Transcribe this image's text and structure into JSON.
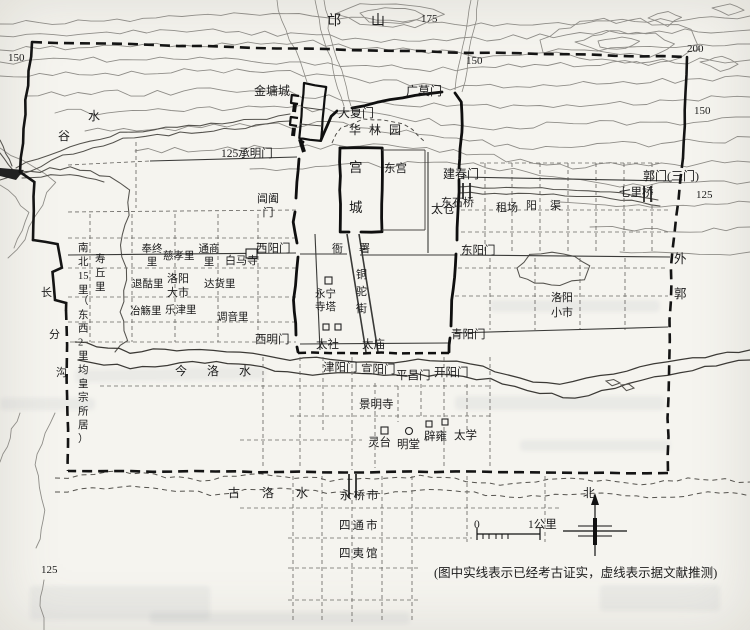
{
  "map": {
    "legend_note": "(图中实线表示已经考古证实，虚线表示据文献推测)",
    "scale": {
      "start": "0",
      "end": "1公里"
    },
    "compass": {
      "north": "北"
    },
    "contour_values": [
      "125",
      "150",
      "175",
      "200"
    ],
    "labels": [
      {
        "n": "contour-label-175",
        "t": "175",
        "x": 421,
        "y": 22,
        "s": 11
      },
      {
        "n": "contour-label-150-nw",
        "t": "150",
        "x": 8,
        "y": 61,
        "s": 11
      },
      {
        "n": "contour-label-150-n",
        "t": "150",
        "x": 466,
        "y": 64,
        "s": 11
      },
      {
        "n": "contour-label-200-ne",
        "t": "200",
        "x": 687,
        "y": 52,
        "s": 11
      },
      {
        "n": "contour-label-150-ne",
        "t": "150",
        "x": 694,
        "y": 114,
        "s": 11
      },
      {
        "n": "contour-label-125-e",
        "t": "125",
        "x": 696,
        "y": 198,
        "s": 11
      },
      {
        "n": "contour-label-125-sw",
        "t": "125",
        "x": 41,
        "y": 573,
        "s": 11
      },
      {
        "n": "mang-shan-label",
        "t": "邙山",
        "x": 327,
        "y": 25,
        "s": 14,
        "ls": 30
      },
      {
        "n": "gu-shui-label-1",
        "t": "谷",
        "x": 58,
        "y": 140,
        "s": 12
      },
      {
        "n": "gu-shui-label-2",
        "t": "水",
        "x": 88,
        "y": 120,
        "s": 12
      },
      {
        "n": "changfengou-label-1",
        "t": "长",
        "x": 41,
        "y": 296,
        "s": 11
      },
      {
        "n": "changfengou-label-2",
        "t": "分",
        "x": 49,
        "y": 338,
        "s": 11
      },
      {
        "n": "changfengou-label-3",
        "t": "沟",
        "x": 56,
        "y": 376,
        "s": 11
      },
      {
        "n": "jin-luo-shui-label",
        "t": "今洛水",
        "x": 175,
        "y": 375,
        "s": 12,
        "ls": 20
      },
      {
        "n": "gu-luo-shui-label",
        "t": "古洛水",
        "x": 228,
        "y": 497,
        "s": 12,
        "ls": 22
      },
      {
        "n": "yang-qu-label",
        "t": "阳渠",
        "x": 526,
        "y": 209,
        "s": 11,
        "ls": 13
      },
      {
        "n": "jinyongcheng-label",
        "t": "金墉城",
        "x": 254,
        "y": 95,
        "s": 12
      },
      {
        "n": "daxiamen-label",
        "t": "大夏门",
        "x": 338,
        "y": 117,
        "s": 12
      },
      {
        "n": "guangmomen-label",
        "t": "广莫门",
        "x": 406,
        "y": 95,
        "s": 12
      },
      {
        "n": "hualinyuan-label",
        "t": "华林园",
        "x": 349,
        "y": 134,
        "s": 12,
        "ls": 8
      },
      {
        "n": "chengmingmen-label",
        "t": "125承明门",
        "x": 221,
        "y": 157,
        "s": 11.5
      },
      {
        "n": "gongcheng-label",
        "l": [
          "宫",
          "城"
        ],
        "x": 349,
        "y": 172,
        "dy": 40,
        "s": 13.5
      },
      {
        "n": "donggong-label",
        "t": "东宫",
        "x": 384,
        "y": 172,
        "s": 11.5
      },
      {
        "n": "jianchunmen-label",
        "t": "建春门",
        "x": 443,
        "y": 178,
        "s": 12
      },
      {
        "n": "changhemen-label",
        "l": [
          "阊阖",
          "门"
        ],
        "x": 268,
        "y": 202,
        "dy": 14,
        "s": 11,
        "a": "m"
      },
      {
        "n": "dongshiqiao-label",
        "t": "东石桥",
        "x": 441,
        "y": 206,
        "s": 11
      },
      {
        "n": "zuchang-label",
        "t": "租场",
        "x": 496,
        "y": 211,
        "s": 11
      },
      {
        "n": "qiliqiao-label",
        "t": "七里桥",
        "x": 619,
        "y": 196,
        "s": 11.5
      },
      {
        "n": "guomen-label",
        "t": "郭门(三门)",
        "x": 643,
        "y": 180,
        "s": 12
      },
      {
        "n": "taicang-label",
        "t": "太仓",
        "x": 431,
        "y": 213,
        "s": 12
      },
      {
        "n": "dongyangmen-label",
        "t": "东阳门",
        "x": 461,
        "y": 254,
        "s": 11.5
      },
      {
        "n": "xiyangmen-label",
        "t": "西阳门",
        "x": 256,
        "y": 252,
        "s": 11.5
      },
      {
        "n": "yashu-label-1",
        "t": "衙",
        "x": 332,
        "y": 252,
        "s": 11
      },
      {
        "n": "yashu-label-2",
        "t": "署",
        "x": 359,
        "y": 252,
        "s": 11
      },
      {
        "n": "tongtuojie-label",
        "l": [
          "铜",
          "驼",
          "街"
        ],
        "x": 356,
        "y": 278,
        "dy": 17,
        "s": 11
      },
      {
        "n": "yongningsi-label",
        "l": [
          "永宁",
          "寺塔"
        ],
        "x": 315,
        "y": 297,
        "dy": 13,
        "s": 10.5
      },
      {
        "n": "baimasi-label",
        "t": "白马寺",
        "x": 225,
        "y": 264,
        "s": 11
      },
      {
        "n": "fengzhongli-label",
        "l": [
          "奉终",
          "里"
        ],
        "x": 152,
        "y": 252,
        "dy": 13,
        "s": 10.5,
        "a": "m"
      },
      {
        "n": "cixiaoli-label",
        "t": "慈孝里",
        "x": 163,
        "y": 259,
        "s": 10.5
      },
      {
        "n": "tongshangli-label",
        "l": [
          "通商",
          "里"
        ],
        "x": 209,
        "y": 252,
        "dy": 13,
        "s": 10.5,
        "a": "m"
      },
      {
        "n": "tuiguli-label",
        "t": "退酤里",
        "x": 132,
        "y": 287,
        "s": 10.5
      },
      {
        "n": "luoyangdashi-label",
        "l": [
          "洛阳",
          "大市"
        ],
        "x": 167,
        "y": 282,
        "dy": 14,
        "s": 11
      },
      {
        "n": "dahuoli-label",
        "t": "达货里",
        "x": 204,
        "y": 287,
        "s": 10.5
      },
      {
        "n": "yeshangli-label",
        "t": "冶觞里",
        "x": 130,
        "y": 314,
        "s": 10.5
      },
      {
        "n": "lejinli-label",
        "t": "乐津里",
        "x": 165,
        "y": 313,
        "s": 10.5
      },
      {
        "n": "tiaoyinli-label",
        "t": "调音里",
        "x": 217,
        "y": 320,
        "s": 10.5
      },
      {
        "n": "shouqiuli-label",
        "l": [
          "寿",
          "丘",
          "里"
        ],
        "x": 95,
        "y": 262,
        "dy": 14,
        "s": 10.5
      },
      {
        "n": "nanbei15li-label",
        "l": [
          "南",
          "北",
          "15",
          "里"
        ],
        "x": 78,
        "y": 251,
        "dy": 14,
        "s": 10.5
      },
      {
        "n": "dongxi2li-label",
        "l": [
          "（",
          "东",
          "西",
          "2",
          "里",
          "均",
          "皇",
          "宗",
          "所",
          "居",
          "）"
        ],
        "x": 78,
        "y": 304,
        "dy": 13.8,
        "s": 10.5
      },
      {
        "n": "ximingmen-label",
        "t": "西明门",
        "x": 255,
        "y": 343,
        "s": 11.5
      },
      {
        "n": "taishe-label",
        "t": "太社",
        "x": 316,
        "y": 348,
        "s": 11.5
      },
      {
        "n": "taimiao-label",
        "t": "太庙",
        "x": 362,
        "y": 348,
        "s": 11.5
      },
      {
        "n": "qingyangmen-label",
        "t": "青阳门",
        "x": 451,
        "y": 338,
        "s": 11.5
      },
      {
        "n": "luoyangxiaoshi-label",
        "l": [
          "洛阳",
          "小市"
        ],
        "x": 551,
        "y": 301,
        "dy": 15,
        "s": 11
      },
      {
        "n": "waiguo-label",
        "l": [
          "外",
          "郭"
        ],
        "x": 674,
        "y": 263,
        "dy": 35,
        "s": 12.5
      },
      {
        "n": "jinyangmen-label",
        "t": "津阳门",
        "x": 323,
        "y": 371,
        "s": 11.5
      },
      {
        "n": "xuanyangmen-label",
        "t": "宣阳门",
        "x": 361,
        "y": 373,
        "s": 11.5
      },
      {
        "n": "pingchangmen-label",
        "t": "平昌门",
        "x": 396,
        "y": 379,
        "s": 11.5
      },
      {
        "n": "kaiyangmen-label",
        "t": "开阳门",
        "x": 434,
        "y": 376,
        "s": 11.5
      },
      {
        "n": "jingmingsi-label",
        "t": "景明寺",
        "x": 359,
        "y": 408,
        "s": 11.5
      },
      {
        "n": "lingtai-label",
        "t": "灵台",
        "x": 368,
        "y": 446,
        "s": 11.5
      },
      {
        "n": "mingtang-label",
        "t": "明堂",
        "x": 397,
        "y": 448,
        "s": 11.5
      },
      {
        "n": "biyong-label",
        "t": "辟雍",
        "x": 424,
        "y": 440,
        "s": 11.5
      },
      {
        "n": "taixue-label",
        "t": "太学",
        "x": 454,
        "y": 439,
        "s": 11.5
      },
      {
        "n": "yongqiaoshi-label",
        "t": "永桥市",
        "x": 340,
        "y": 499,
        "s": 11.5,
        "ls": 2
      },
      {
        "n": "sitongshi-label",
        "t": "四通市",
        "x": 339,
        "y": 529,
        "s": 11.5,
        "ls": 2
      },
      {
        "n": "siyiguan-label",
        "t": "四夷馆",
        "x": 339,
        "y": 557,
        "s": 11.5,
        "ls": 2
      },
      {
        "n": "north-label",
        "t": "北",
        "x": 583,
        "y": 497,
        "s": 12
      },
      {
        "n": "scale-label-0",
        "t": "0",
        "x": 474,
        "y": 528,
        "s": 11.5
      },
      {
        "n": "scale-label-1km",
        "t": "1公里",
        "x": 528,
        "y": 528,
        "s": 11.5
      },
      {
        "n": "caption",
        "t": "(图中实线表示已经考古证实，虚线表示据文献推测)",
        "x": 434,
        "y": 577,
        "s": 12.5
      }
    ],
    "icons": [
      {
        "n": "baimasi-temple-icon",
        "sh": "rect",
        "x": 246,
        "y": 249,
        "w": 11,
        "h": 9
      },
      {
        "n": "yongningsi-pagoda-icon",
        "sh": "rect",
        "x": 325,
        "y": 277,
        "w": 7,
        "h": 7
      },
      {
        "n": "taishe-altar-icon",
        "sh": "rect",
        "x": 323,
        "y": 324,
        "w": 6,
        "h": 6
      },
      {
        "n": "taimiao-altar-icon",
        "sh": "rect",
        "x": 335,
        "y": 324,
        "w": 6,
        "h": 6
      },
      {
        "n": "lingtai-platform-icon",
        "sh": "rect",
        "x": 381,
        "y": 427,
        "w": 7,
        "h": 7
      },
      {
        "n": "mingtang-hall-icon",
        "sh": "circle",
        "x": 409,
        "y": 431,
        "r": 3.5
      },
      {
        "n": "biyong-icon-a",
        "sh": "rect",
        "x": 426,
        "y": 421,
        "w": 6,
        "h": 6
      },
      {
        "n": "biyong-icon-b",
        "sh": "rect",
        "x": 442,
        "y": 419,
        "w": 6,
        "h": 6
      }
    ]
  }
}
